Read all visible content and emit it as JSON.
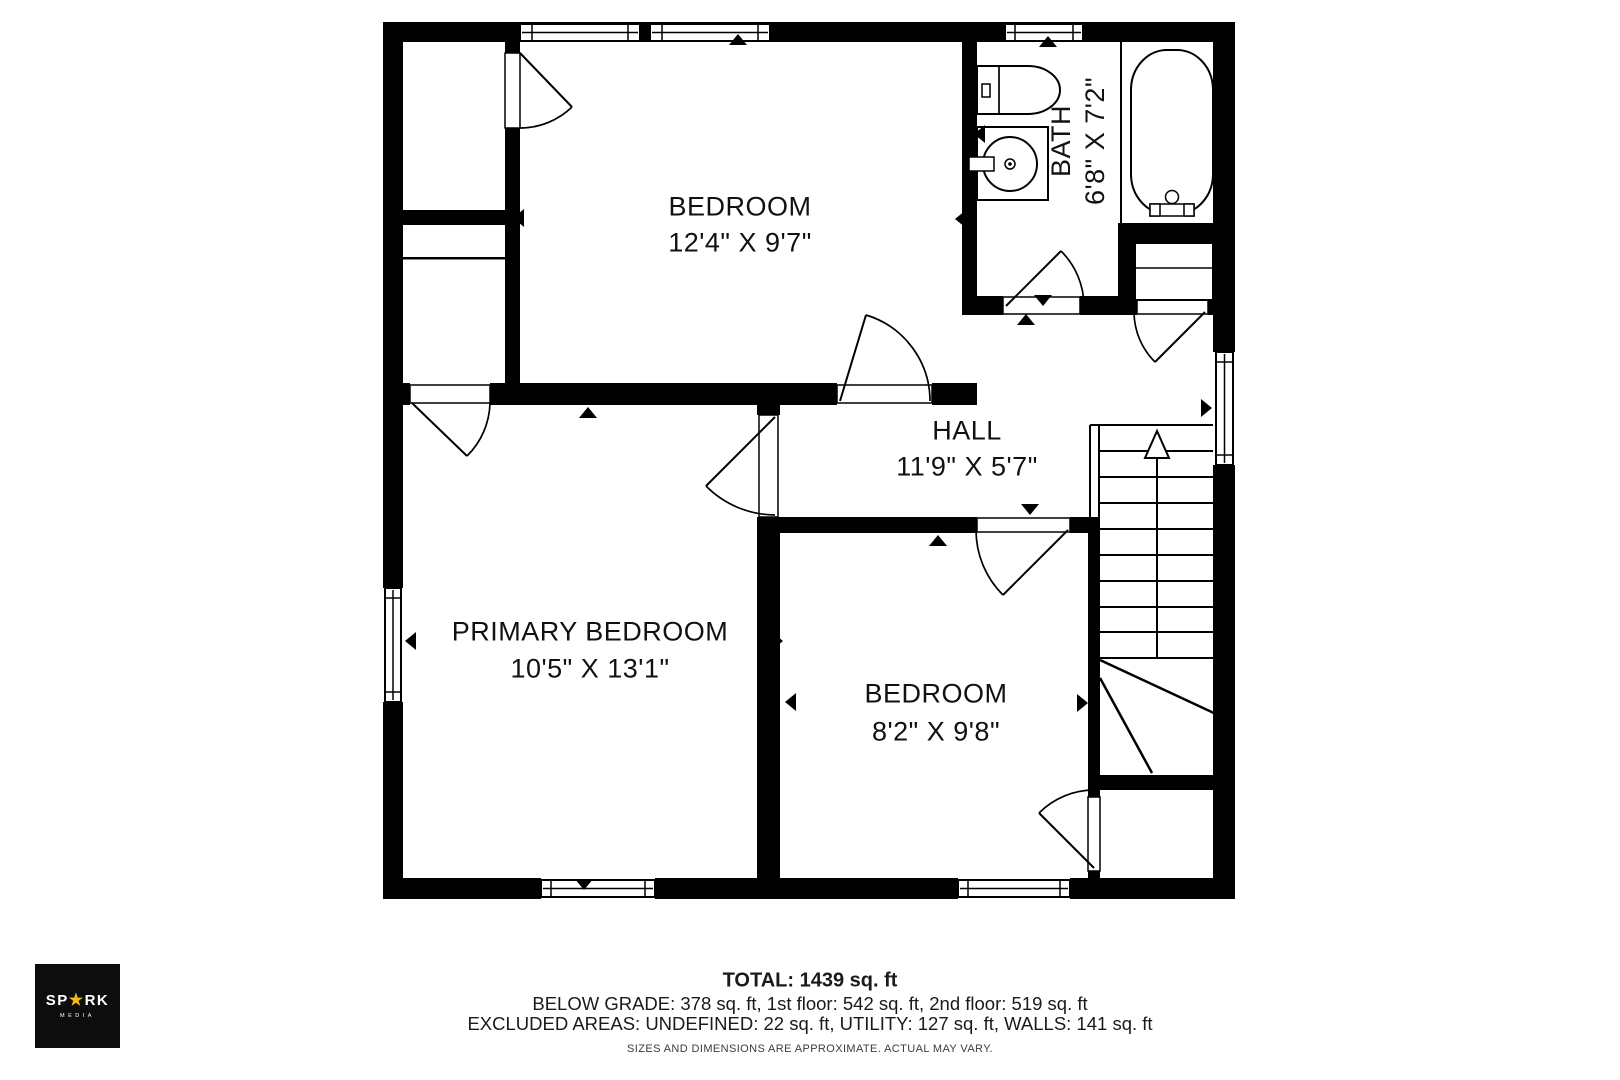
{
  "rooms": [
    {
      "id": "bedroom-top",
      "name": "BEDROOM",
      "dims": "12'4\" X 9'7\""
    },
    {
      "id": "bath",
      "name": "BATH",
      "dims": "6'8\" X 7'2\""
    },
    {
      "id": "hall",
      "name": "HALL",
      "dims": "11'9\" X 5'7\""
    },
    {
      "id": "primary-bedroom",
      "name": "PRIMARY BEDROOM",
      "dims": "10'5\" X 13'1\""
    },
    {
      "id": "bedroom-bottom",
      "name": "BEDROOM",
      "dims": "8'2\" X 9'8\""
    }
  ],
  "summary": {
    "total": "TOTAL: 1439 sq. ft",
    "breakdown": "BELOW GRADE: 378 sq. ft, 1st floor: 542 sq. ft, 2nd floor: 519 sq. ft",
    "excluded": "EXCLUDED AREAS: UNDEFINED: 22 sq. ft, UTILITY: 127 sq. ft, WALLS: 141 sq. ft"
  },
  "disclaimer": "SIZES AND DIMENSIONS ARE APPROXIMATE. ACTUAL MAY VARY.",
  "logo": {
    "brand_left": "SP",
    "brand_star": "★",
    "brand_right": "RK",
    "subtitle": "MEDIA",
    "star_color": "#f5b81c",
    "background": "#0d0d0d"
  },
  "colors": {
    "wall": "#000000",
    "background": "#ffffff",
    "text": "#111111"
  }
}
